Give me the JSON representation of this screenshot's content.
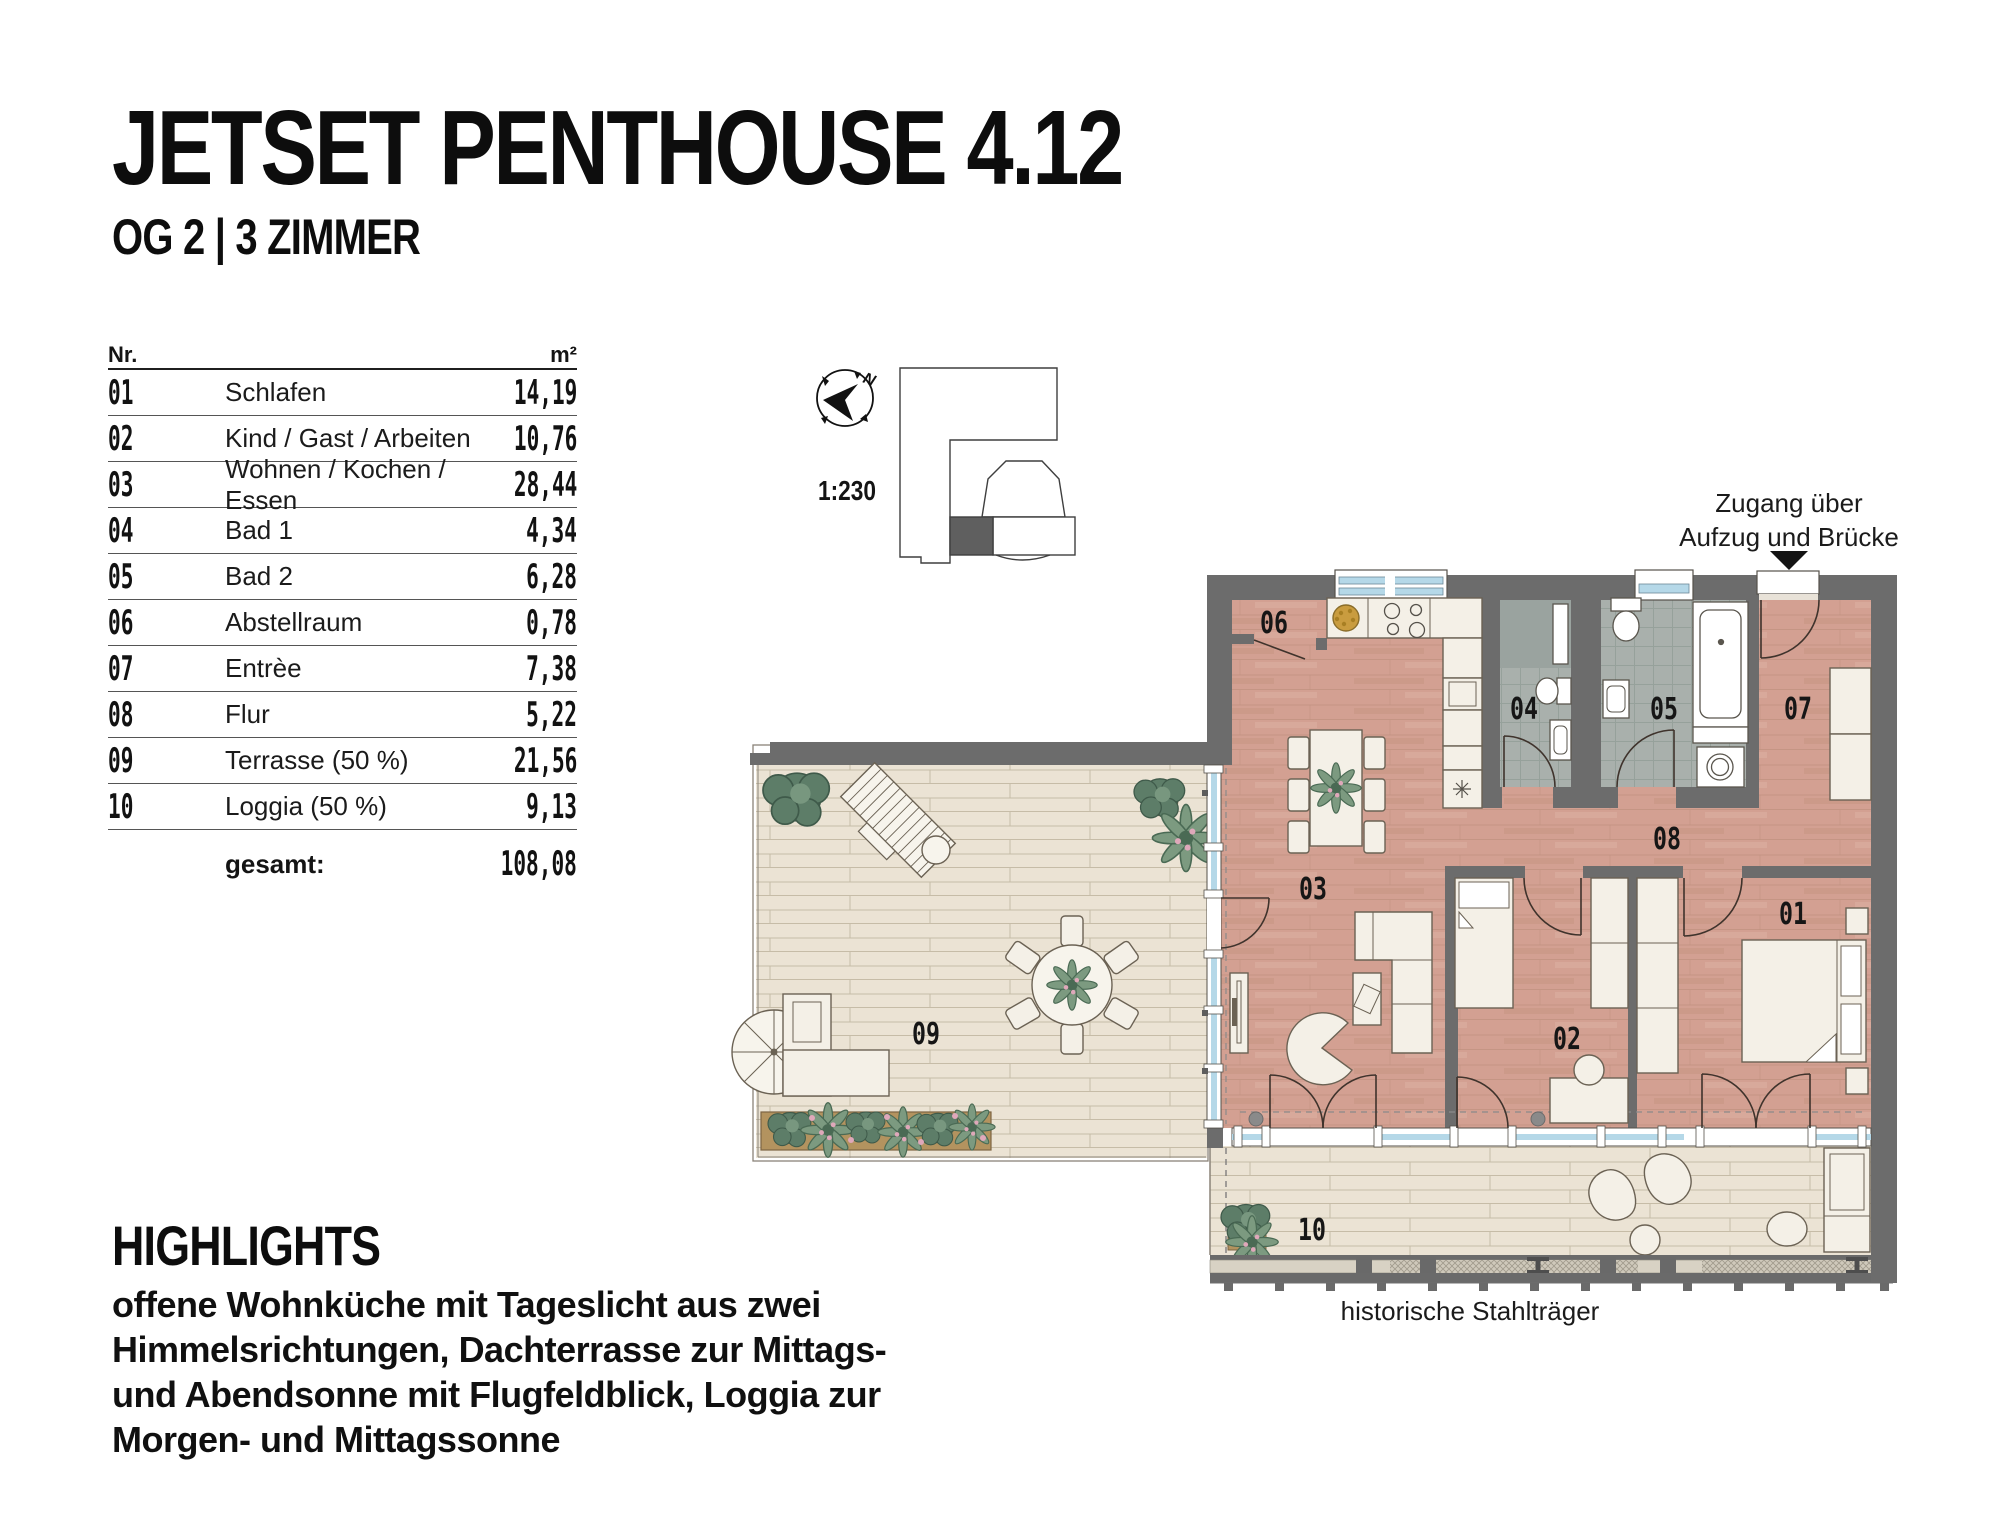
{
  "header": {
    "title": "JETSET PENTHOUSE 4.12",
    "subtitle": "OG 2 | 3 ZIMMER"
  },
  "area_table": {
    "col_nr": "Nr.",
    "col_m2": "m²",
    "rows": [
      {
        "nr": "01",
        "name": "Schlafen",
        "m2": "14,19"
      },
      {
        "nr": "02",
        "name": "Kind / Gast / Arbeiten",
        "m2": "10,76"
      },
      {
        "nr": "03",
        "name": "Wohnen / Kochen / Essen",
        "m2": "28,44"
      },
      {
        "nr": "04",
        "name": "Bad 1",
        "m2": "4,34"
      },
      {
        "nr": "05",
        "name": "Bad 2",
        "m2": "6,28"
      },
      {
        "nr": "06",
        "name": "Abstellraum",
        "m2": "0,78"
      },
      {
        "nr": "07",
        "name": "Entrèe",
        "m2": "7,38"
      },
      {
        "nr": "08",
        "name": "Flur",
        "m2": "5,22"
      },
      {
        "nr": "09",
        "name": "Terrasse (50 %)",
        "m2": "21,56"
      },
      {
        "nr": "10",
        "name": "Loggia (50 %)",
        "m2": "9,13"
      }
    ],
    "total_label": "gesamt:",
    "total_value": "108,08"
  },
  "floorplan": {
    "scale": "1:230",
    "north": "N",
    "access_note": [
      "Zugang über",
      "Aufzug und Brücke"
    ],
    "steel_note": "historische Stahlträger",
    "labels": {
      "r01": "01",
      "r02": "02",
      "r03": "03",
      "r04": "04",
      "r05": "05",
      "r06": "06",
      "r07": "07",
      "r08": "08",
      "r09": "09",
      "r10": "10"
    }
  },
  "highlights": {
    "heading": "HIGHLIGHTS",
    "lines": [
      "offene Wohnküche mit Tageslicht aus zwei",
      "Himmelsrichtungen, Dachterrasse zur Mittags-",
      "und Abendsonne mit Flugfeldblick, Loggia zur",
      "Morgen- und Mittagssonne"
    ]
  },
  "colors": {
    "wall": "#6c6c6c",
    "floor_wood": "#d3a092",
    "floor_tile": "#a9b0ac",
    "deck": "#ebe3d4",
    "window_glass": "#b5d8e8",
    "furniture": "#f4f0e7",
    "plant_green": "#5d7d68",
    "planter_brown": "#b3935f",
    "flower_pink": "#dfa8ba",
    "text": "#141414"
  }
}
